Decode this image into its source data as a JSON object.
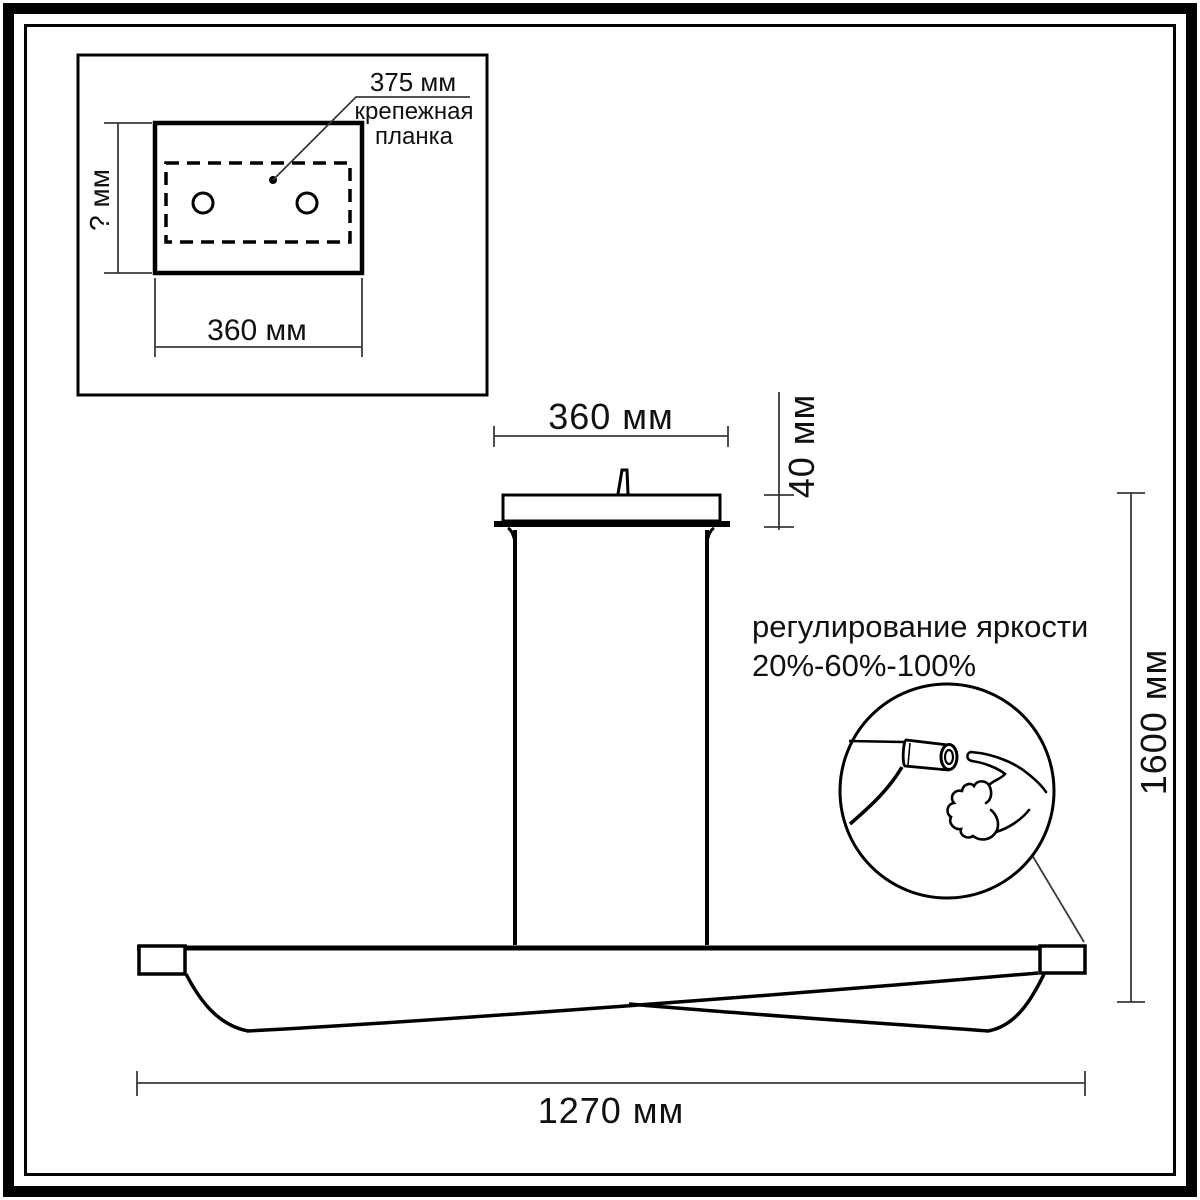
{
  "diagram": {
    "type": "pendant-lamp-dimension-drawing",
    "inset": {
      "dim_plate_length": "375 мм",
      "plate_label_line1": "крепежная",
      "plate_label_line2": "планка",
      "dim_canopy_depth": "? мм",
      "dim_canopy_width": "360 мм"
    },
    "main": {
      "dim_canopy_width": "360 мм",
      "dim_canopy_height": "40 мм",
      "dim_total_height": "1600 мм",
      "dim_lamp_length": "1270 мм",
      "brightness_title": "регулирование яркости",
      "brightness_levels": "20%-60%-100%"
    },
    "colors": {
      "line": "#000000",
      "dim_line": "#3a3a3a",
      "background": "#ffffff"
    }
  }
}
